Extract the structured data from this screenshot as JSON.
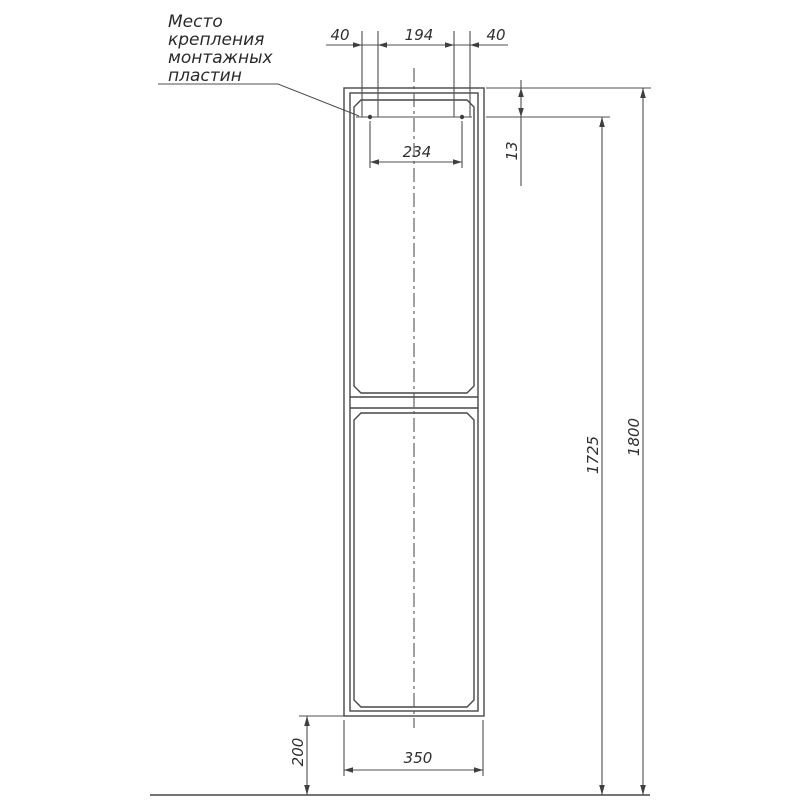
{
  "drawing": {
    "note": {
      "line1": "Место",
      "line2": "крепления",
      "line3": "монтажных",
      "line4": "пластин"
    },
    "dims": {
      "plate_offset_left": "40",
      "plate_gap": "194",
      "plate_offset_right": "40",
      "plate_centers_span": "234",
      "plate_top_inset": "13",
      "mount_line_height": "1725",
      "overall_height": "1800",
      "cabinet_width": "350",
      "floor_clearance": "200"
    },
    "colors": {
      "line": "#474747",
      "text": "#2f2f2f",
      "background": "#ffffff"
    }
  }
}
